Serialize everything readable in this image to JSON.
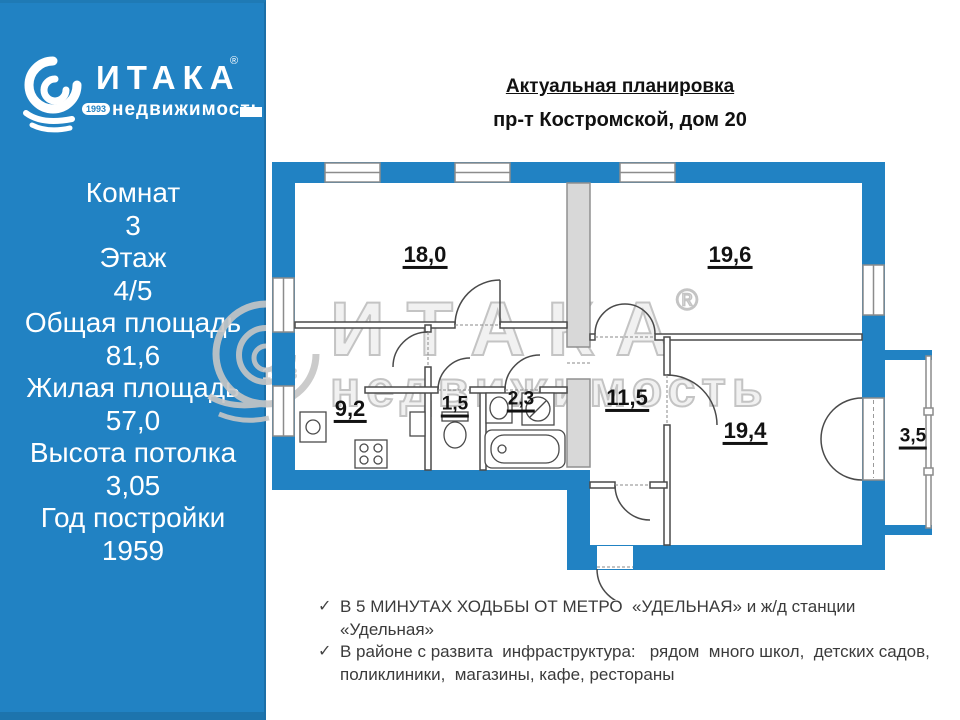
{
  "sidebar": {
    "logo": {
      "brand": "ИТАКА",
      "reg": "®",
      "sub": "недвижимость",
      "year": "1993"
    },
    "stats": [
      "Комнат",
      "3",
      "Этаж",
      "4/5",
      "Общая площадь",
      "81,6",
      "Жилая площадь",
      "57,0",
      "Высота потолка",
      "3,05",
      "Год постройки",
      "1959"
    ]
  },
  "header": {
    "title": "Актуальная планировка",
    "address": "пр-т Костромской, дом 20"
  },
  "plan": {
    "areas": {
      "r18": "18,0",
      "r196": "19,6",
      "r92": "9,2",
      "r15": "1,5",
      "r23": "2,3",
      "r115": "11,5",
      "r194": "19,4",
      "r35": "3,5"
    }
  },
  "watermark": {
    "brand": "ИТАКА",
    "reg": "®",
    "sub": "недвижимость",
    "year": "1993"
  },
  "bullets": [
    {
      "check": "✓",
      "text": "В 5 МИНУТАХ ХОДЬБЫ ОТ МЕТРО  «УДЕЛЬНАЯ» и ж/д станции  «Удельная»"
    },
    {
      "check": "✓",
      "text": "В районе с развита  инфраструктура:   рядом  много школ,  детских садов,"
    },
    {
      "check": "",
      "text": "поликлиники,  магазины, кафе, рестораны"
    }
  ],
  "colors": {
    "accent_blue": "#2182c3",
    "wall_blue": "#2182c3",
    "shaft_gray": "#d8d8d8"
  }
}
